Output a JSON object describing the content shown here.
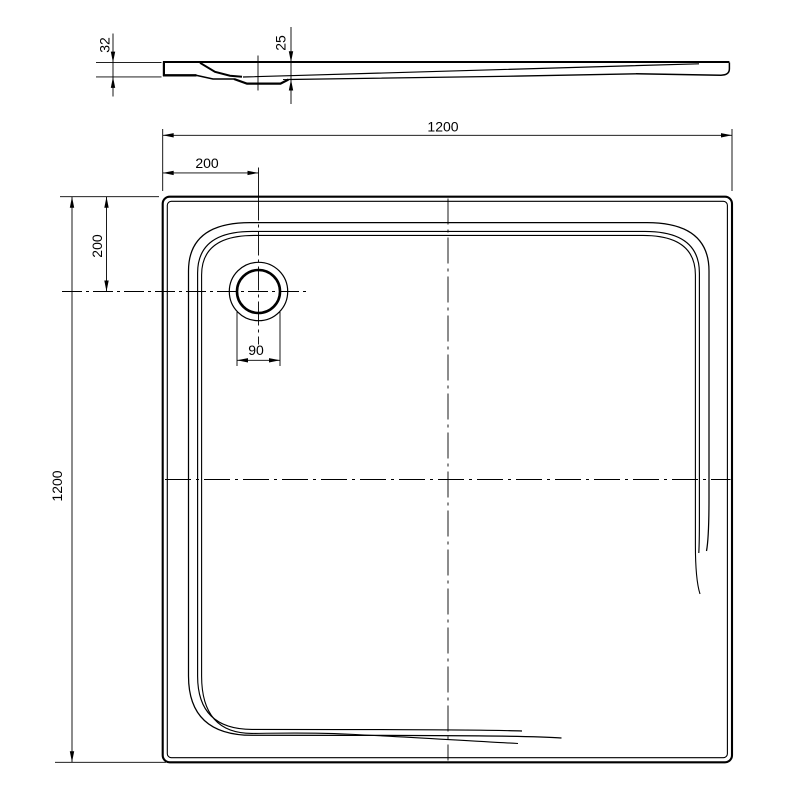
{
  "diagram": {
    "type": "technical-drawing",
    "subject": "Square shower tray - plan view with drain and side section view",
    "units": "mm",
    "background_color": "#ffffff",
    "line_color": "#000000",
    "section_view": {
      "dim_total_height": "32",
      "dim_drain_depth": "25"
    },
    "plan_view": {
      "dim_overall_width": "1200",
      "dim_overall_length": "1200",
      "dim_drain_offset_horizontal": "200",
      "dim_drain_offset_vertical": "200",
      "dim_drain_diameter": "90"
    }
  }
}
